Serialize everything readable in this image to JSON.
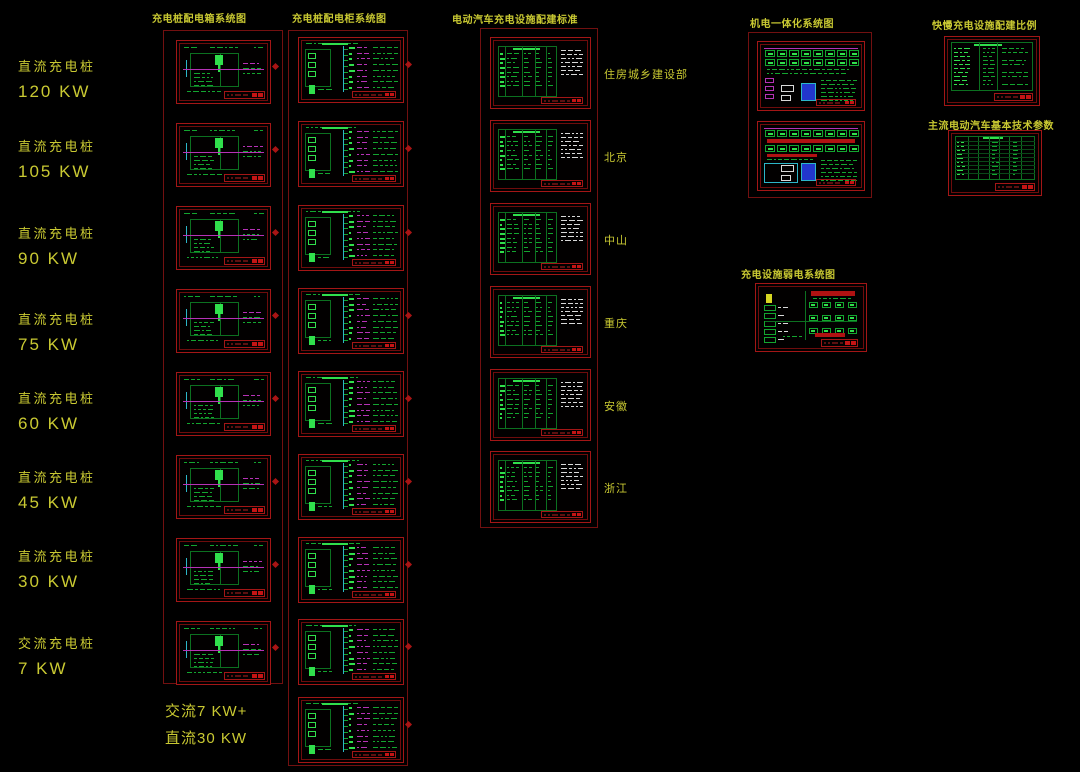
{
  "canvas": {
    "width": 1080,
    "height": 772
  },
  "palette": {
    "background": "#000000",
    "label_yellow": "#c9c932",
    "group_border": "#721010",
    "panel_border": "#a31616",
    "panel_inner_border": "#6e0c0c",
    "green": "#13a52f",
    "green_dim": "#0c7020",
    "green_bright": "#30df4c",
    "magenta": "#b632b6",
    "cyan": "#2cb6c8",
    "blue": "#2236cc",
    "red": "#c41414",
    "red_bar": "#b01212",
    "white": "#d8d8d8",
    "yellow_box": "#d6d622"
  },
  "headers": {
    "col1": "充电桩配电箱系统图",
    "col2": "充电桩配电柜系统图",
    "col3": "电动汽车充电设施配建标准",
    "mech": "机电一体化系统图",
    "ratio": "快慢充电设施配建比例",
    "params": "主流电动汽车基本技术参数",
    "weak": "充电设施弱电系统图"
  },
  "left_labels": [
    {
      "line1": "直流充电桩",
      "line2": "120 KW"
    },
    {
      "line1": "直流充电桩",
      "line2": "105 KW"
    },
    {
      "line1": "直流充电桩",
      "line2": "90 KW"
    },
    {
      "line1": "直流充电桩",
      "line2": "75 KW"
    },
    {
      "line1": "直流充电桩",
      "line2": "60 KW"
    },
    {
      "line1": "直流充电桩",
      "line2": "45 KW"
    },
    {
      "line1": "直流充电桩",
      "line2": "30 KW"
    },
    {
      "line1": "交流充电桩",
      "line2": "7 KW"
    }
  ],
  "combo_label": {
    "line1": "交流7 KW+",
    "line2": "直流30 KW"
  },
  "region_labels": [
    "住房城乡建设部",
    "北京",
    "中山",
    "重庆",
    "安徽",
    "浙江"
  ],
  "panel_counts": {
    "col1": 8,
    "col2": 9,
    "col3": 6,
    "mech": 2,
    "ratio": 1,
    "params": 1,
    "weak": 1
  }
}
